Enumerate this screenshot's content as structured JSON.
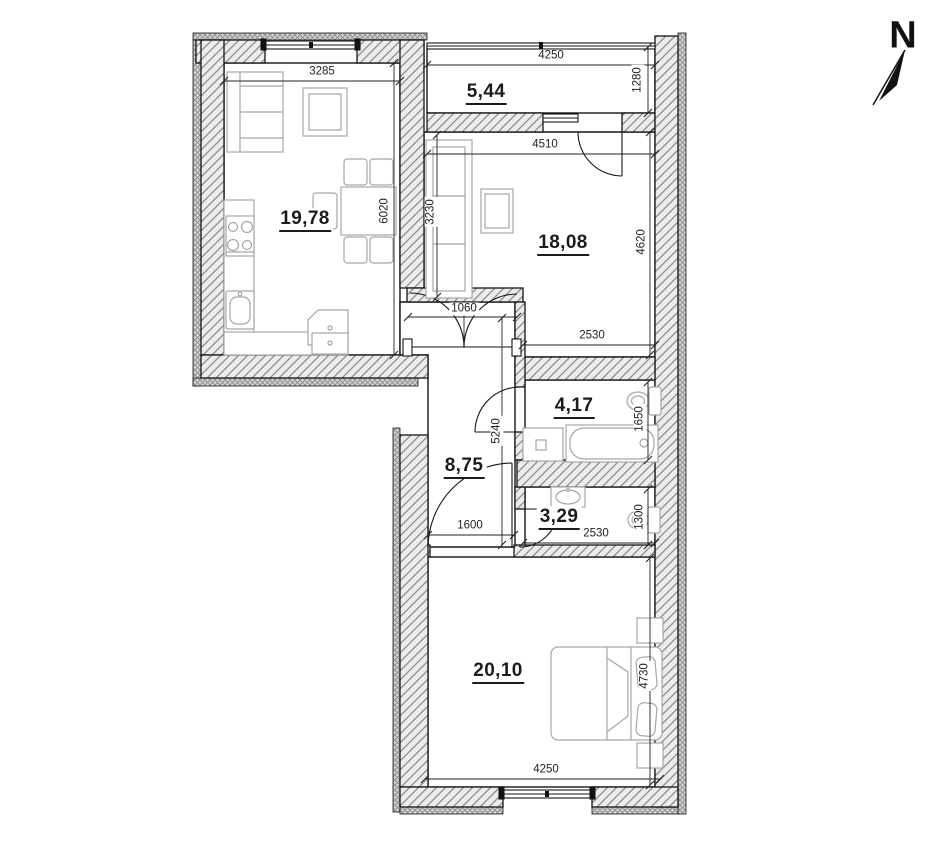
{
  "title": "apartment floor plan",
  "north": {
    "label": "N"
  },
  "rooms": {
    "kitchen_living": "19,78",
    "balcony": "5,44",
    "living_room": "18,08",
    "bathroom": "4,17",
    "hallway": "8,75",
    "wc": "3,29",
    "bedroom": "20,10"
  },
  "dims": {
    "kitchen_top": "3285",
    "balcony_top": "4250",
    "balcony_depth": "1280",
    "room_top": "4510",
    "kitchen_height": "6020",
    "sofa_span": "3230",
    "room_height": "4620",
    "passage_opening": "1060",
    "room_bottom": "2530",
    "bath_depth": "1650",
    "hall_span": "5240",
    "bedroom_door": "1600",
    "wc_width": "2530",
    "wc_depth": "1300",
    "bedroom_depth": "4730",
    "bedroom_width": "4250"
  },
  "colors": {
    "line": "#1a1a1a",
    "wall_fill": "#ececec",
    "hatch_line": "#8c8c8c",
    "furniture_line": "#a6a6a6",
    "dim_line": "#222222"
  }
}
